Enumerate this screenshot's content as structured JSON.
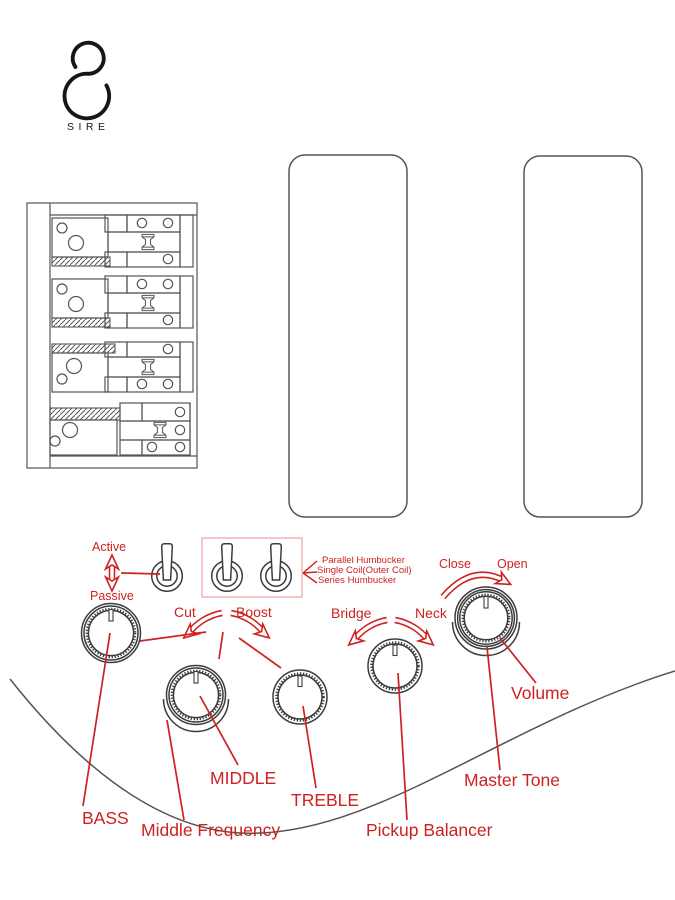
{
  "brand": {
    "name": "SIRE"
  },
  "colors": {
    "red": "#ce2121",
    "pink": "#f0b4b4",
    "ink": "#3c3c3c",
    "gray": "#555555"
  },
  "switches": {
    "active_passive": {
      "up": "Active",
      "down": "Passive"
    },
    "coil_tap": {
      "options": [
        "Parallel Humbucker",
        "Single Coil(Outer Coil)",
        "Series Humbucker"
      ]
    }
  },
  "arrows": {
    "eq": {
      "left": "Cut",
      "right": "Boost"
    },
    "balance": {
      "left": "Bridge",
      "right": "Neck"
    },
    "volume": {
      "left": "Close",
      "right": "Open"
    }
  },
  "knobs": {
    "bass": "BASS",
    "middle": "MIDDLE",
    "middle_frequency": "Middle Frequency",
    "treble": "TREBLE",
    "pickup_balancer": "Pickup Balancer",
    "master_tone": "Master Tone",
    "volume": "Volume"
  }
}
